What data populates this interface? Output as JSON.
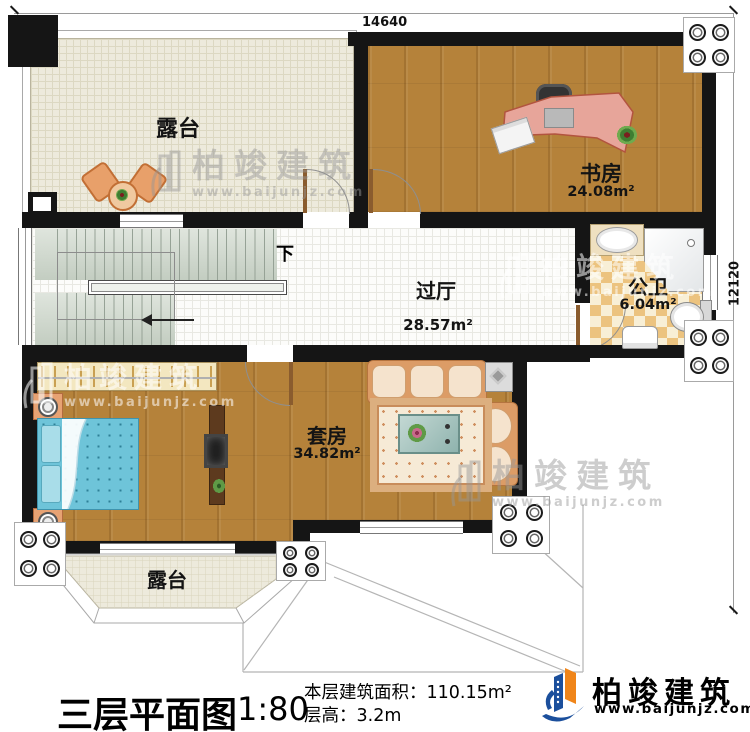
{
  "dimensions": {
    "top": "14640",
    "right": "12120"
  },
  "rooms": {
    "terrace_top": {
      "name": "露台"
    },
    "study": {
      "name": "书房",
      "area": "24.08m²"
    },
    "hall": {
      "name": "过厅",
      "area": "28.57m²"
    },
    "bathroom": {
      "name": "公卫",
      "area": "6.04m²"
    },
    "suite": {
      "name": "套房",
      "area": "34.82m²"
    },
    "terrace_bottom": {
      "name": "露台"
    }
  },
  "stairs": {
    "down_label": "下"
  },
  "title_block": {
    "title": "三层平面图",
    "scale": "1:80",
    "area_text": "本层建筑面积：110.15m²",
    "height_text": "层高：3.2m"
  },
  "brand": {
    "name": "柏竣建筑",
    "url": "www.baijunjz.com"
  },
  "watermark": {
    "name": "柏竣建筑",
    "url": "www.baijunjz.com"
  },
  "colors": {
    "wall": "#151515",
    "wood": "#b5823a",
    "brand_blue": "#1b4f9c",
    "brand_orange": "#f08519"
  }
}
